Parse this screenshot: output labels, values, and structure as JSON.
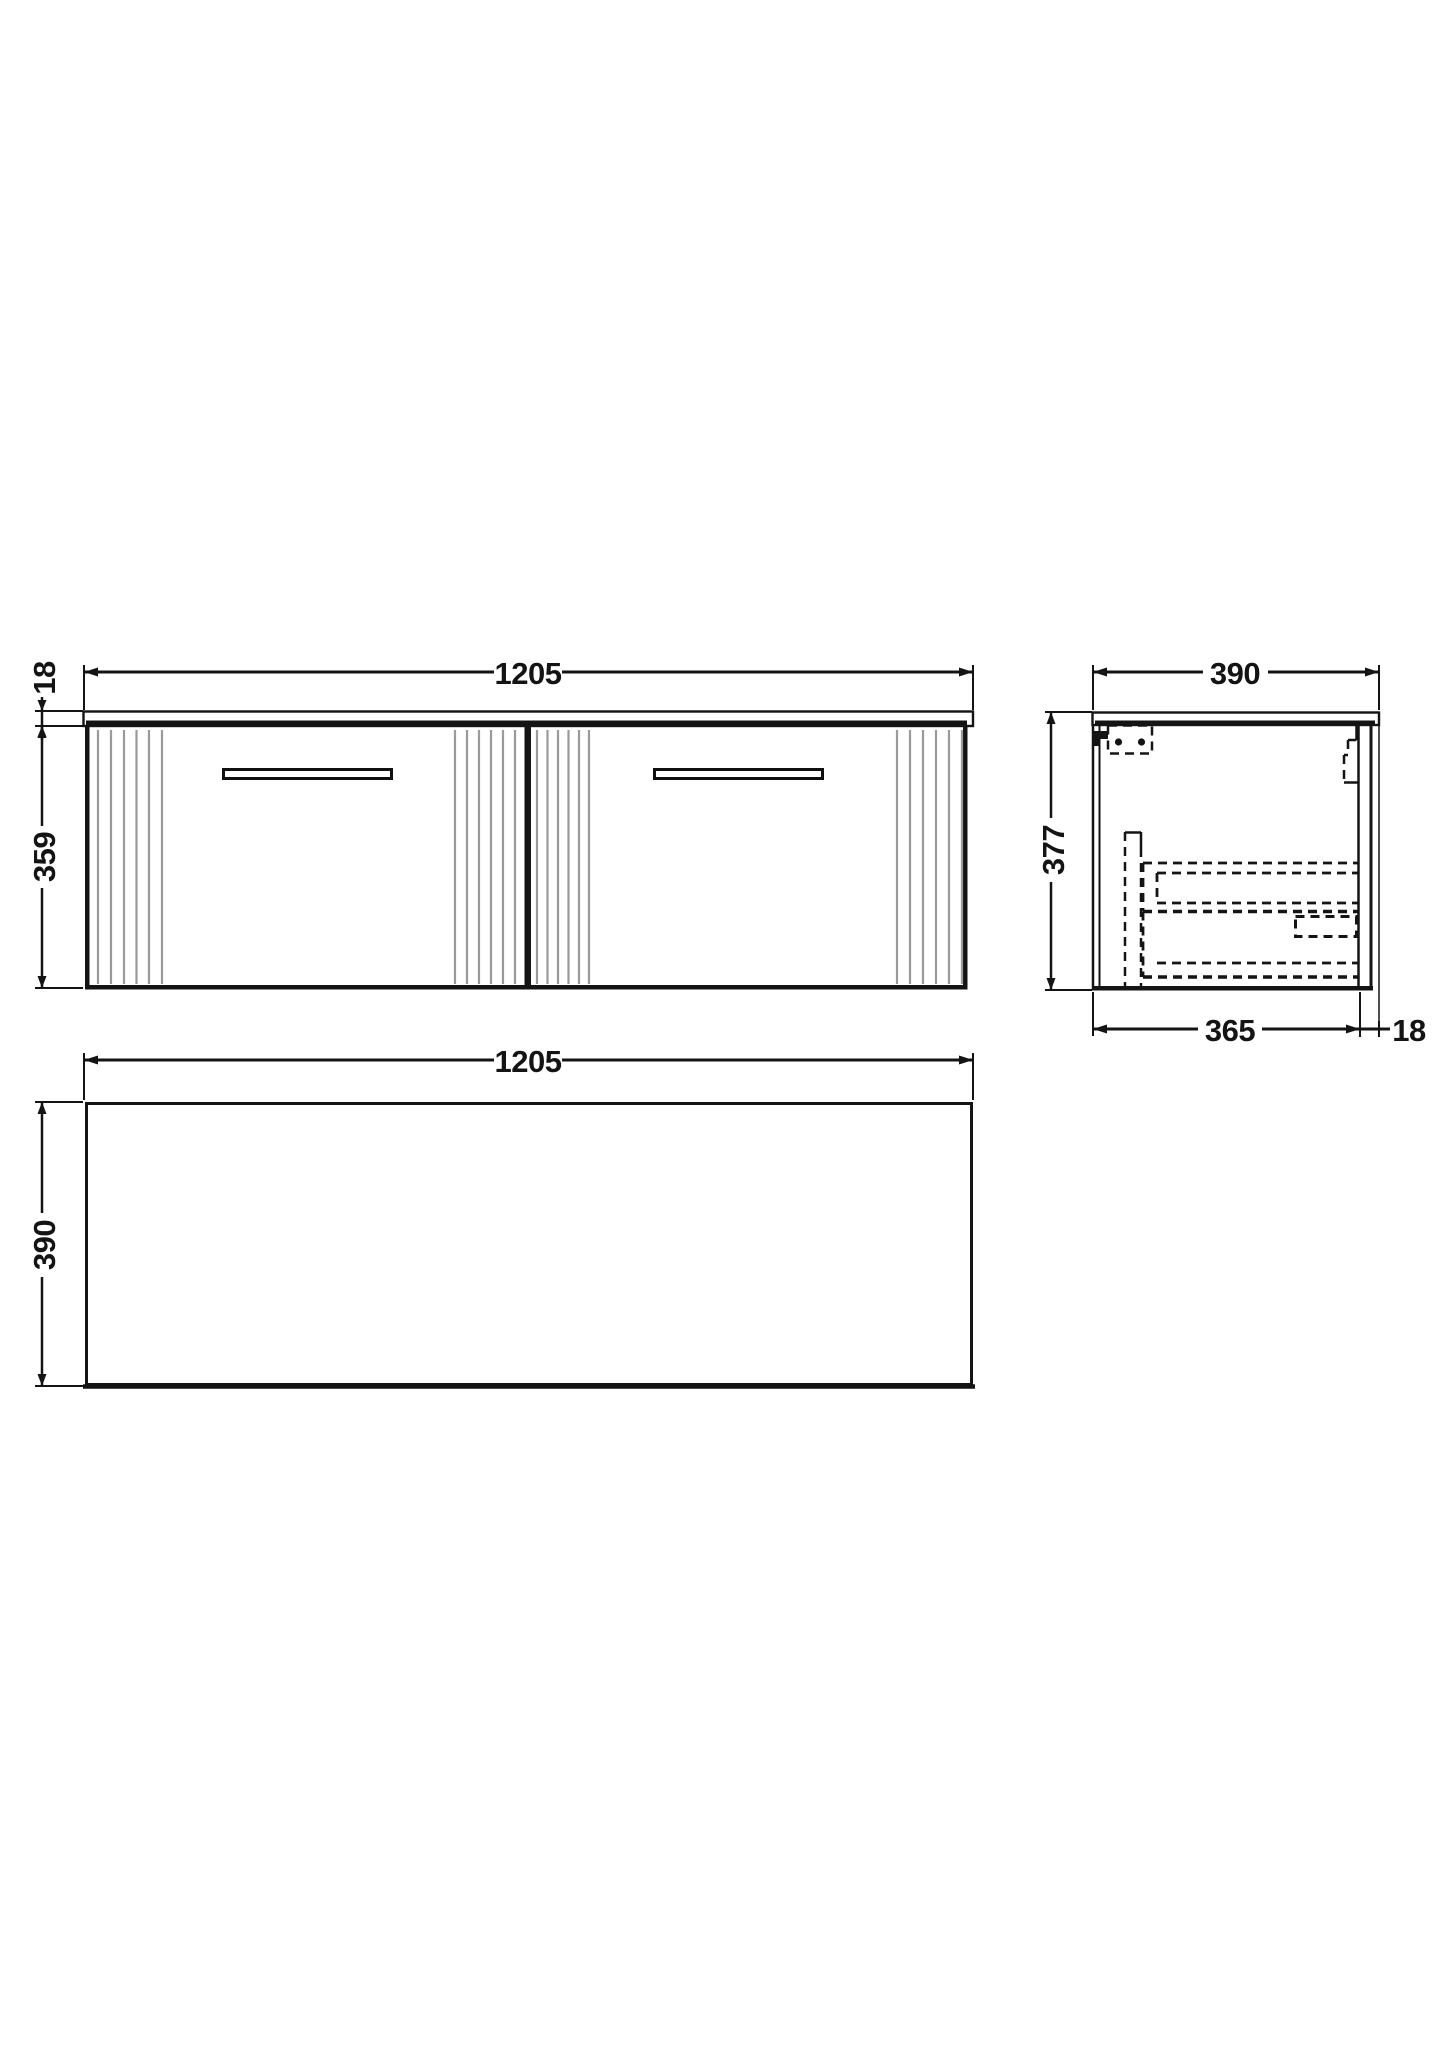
{
  "views": {
    "front": {
      "width": "1205",
      "worktop_thickness": "18",
      "height": "359"
    },
    "side": {
      "depth": "390",
      "height": "377",
      "internal_depth": "365",
      "back_thickness": "18"
    },
    "plan": {
      "width": "1205",
      "depth": "390"
    }
  },
  "colors": {
    "line": "#141414",
    "flute": "#9a9a9a",
    "handle_outline": "#101010",
    "background": "#ffffff"
  }
}
